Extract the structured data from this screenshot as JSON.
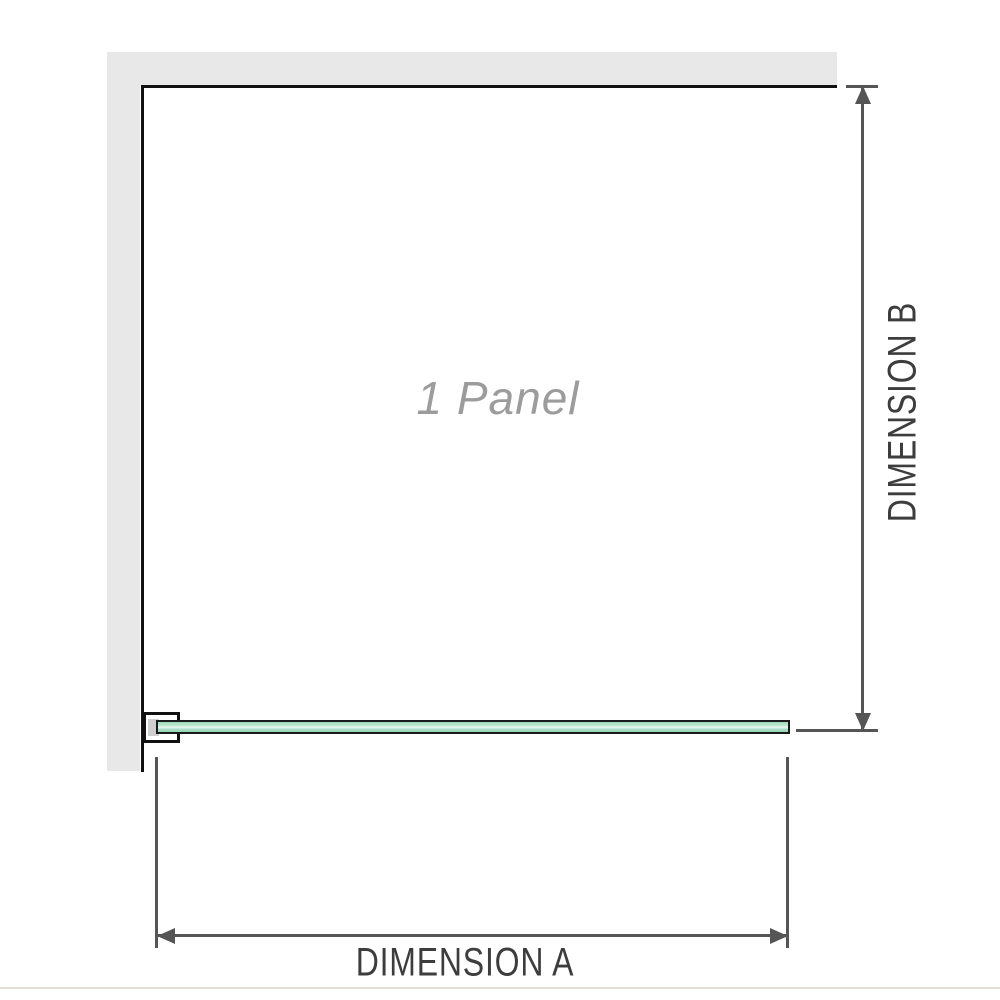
{
  "diagram": {
    "panel_label": "1 Panel",
    "dimension_a_label": "DIMENSION A",
    "dimension_b_label": "DIMENSION B"
  },
  "icons": {
    "arrow_left": "left-arrowhead",
    "arrow_right": "right-arrowhead",
    "arrow_up": "up-arrowhead",
    "arrow_down": "down-arrowhead"
  },
  "colors": {
    "wall": "#e8e8e8",
    "outline": "#111111",
    "glass_border": "#1a1a1a",
    "glass_green": "#9cd9ba",
    "glass_highlight": "#e8f7ee",
    "dimension_line": "#555555",
    "label_text": "#3d3d3d",
    "panel_text": "#9c9c9c",
    "bracket_shim": "#cfcfcf",
    "footer_line": "#e2dfd7"
  }
}
